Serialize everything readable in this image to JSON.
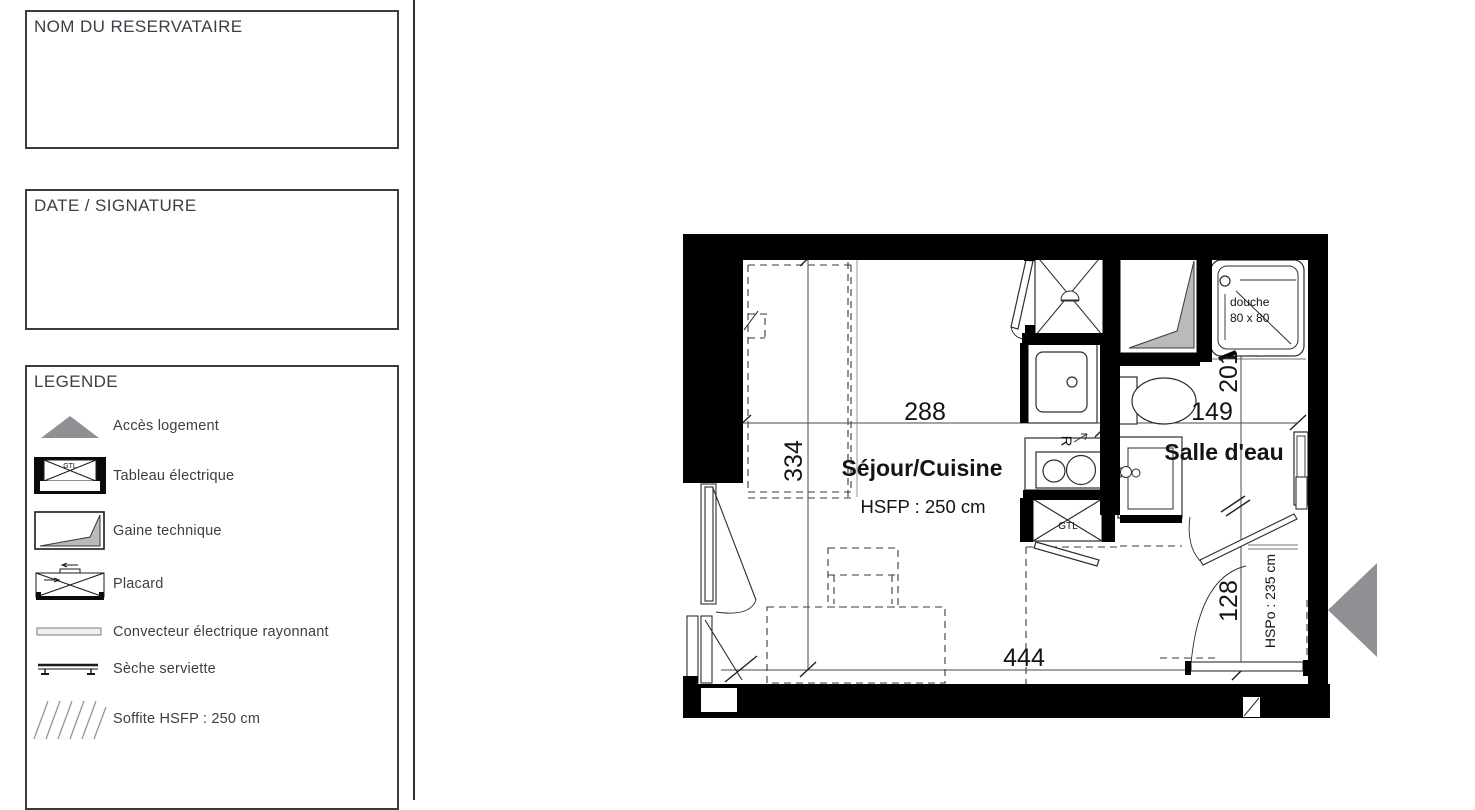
{
  "panel": {
    "boxes": [
      {
        "title": "NOM DU RESERVATAIRE"
      },
      {
        "title": "DATE / SIGNATURE"
      }
    ],
    "legend": {
      "title": "LEGENDE",
      "items": [
        {
          "icon": "access-triangle-icon",
          "label": "Accès logement"
        },
        {
          "icon": "electrical-panel-icon",
          "label": "Tableau électrique",
          "badge": "GTL"
        },
        {
          "icon": "technical-duct-icon",
          "label": "Gaine technique"
        },
        {
          "icon": "closet-icon",
          "label": "Placard"
        },
        {
          "icon": "convector-icon",
          "label": "Convecteur électrique rayonnant"
        },
        {
          "icon": "towel-dryer-icon",
          "label": "Sèche serviette"
        },
        {
          "icon": "soffit-hatch-icon",
          "label": "Soffite HSFP : 250 cm"
        }
      ]
    }
  },
  "plan": {
    "rooms": {
      "sejour_cuisine": {
        "name": "Séjour/Cuisine",
        "ceiling": "HSFP : 250 cm"
      },
      "salle_eau": {
        "name": "Salle d'eau"
      },
      "entry_ceiling": "HSPo : 235 cm"
    },
    "dims": {
      "top": "288",
      "left": "334",
      "bottom": "444",
      "bath_v": "201",
      "bath_h": "149",
      "entry": "128"
    },
    "fixtures": {
      "shower_l1": "douche",
      "shower_l2": "80 x 80",
      "gtl": "GTL",
      "fridge": "R"
    },
    "colors": {
      "wall": "#000000",
      "access_gray": "#8e9093",
      "duct_gray": "#b9babc",
      "line": "#2d2d2d"
    }
  }
}
